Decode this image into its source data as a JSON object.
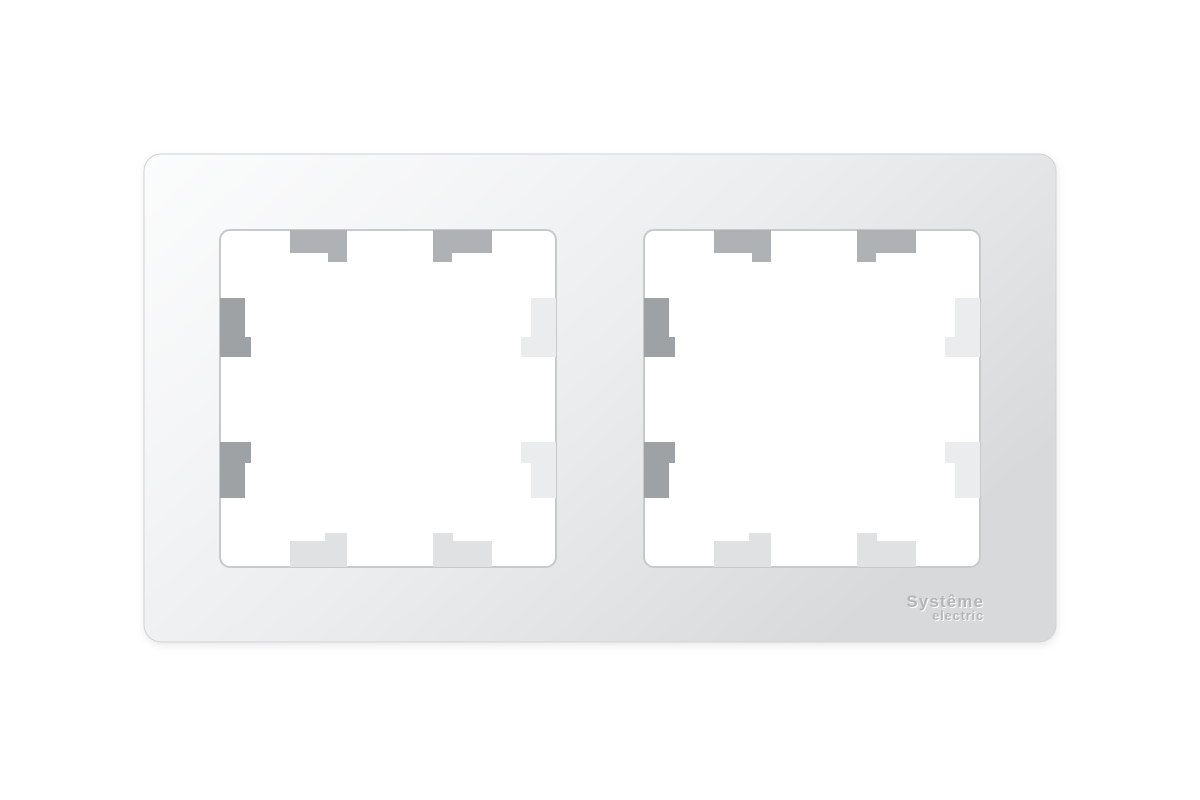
{
  "photo": {
    "subject": "White double (2-gang) electrical wall-plate frame, front view, two square openings with stepped mounting tabs",
    "brand": {
      "line1": "Systême",
      "line2": "electric"
    },
    "colors": {
      "background": "#ffffff",
      "plate_grad_0": "#fbfcfc",
      "plate_grad_1": "#f4f5f6",
      "plate_grad_2": "#ebedee",
      "plate_grad_3": "#e1e3e4",
      "plate_grad_4": "#d7d9da",
      "plate_edge": "#d0d3d4",
      "shadow": "#8a8e90",
      "opening_fill": "#ffffff",
      "opening_edge": "#c7cacb",
      "tab_top": "#aeb2b4",
      "tab_left": "#9ea2a4",
      "tab_right": "#eaeced",
      "tab_bottom": "#dfe1e2",
      "logo_text": "#b2b6b8",
      "logo_highlight": "#fefefe"
    }
  }
}
